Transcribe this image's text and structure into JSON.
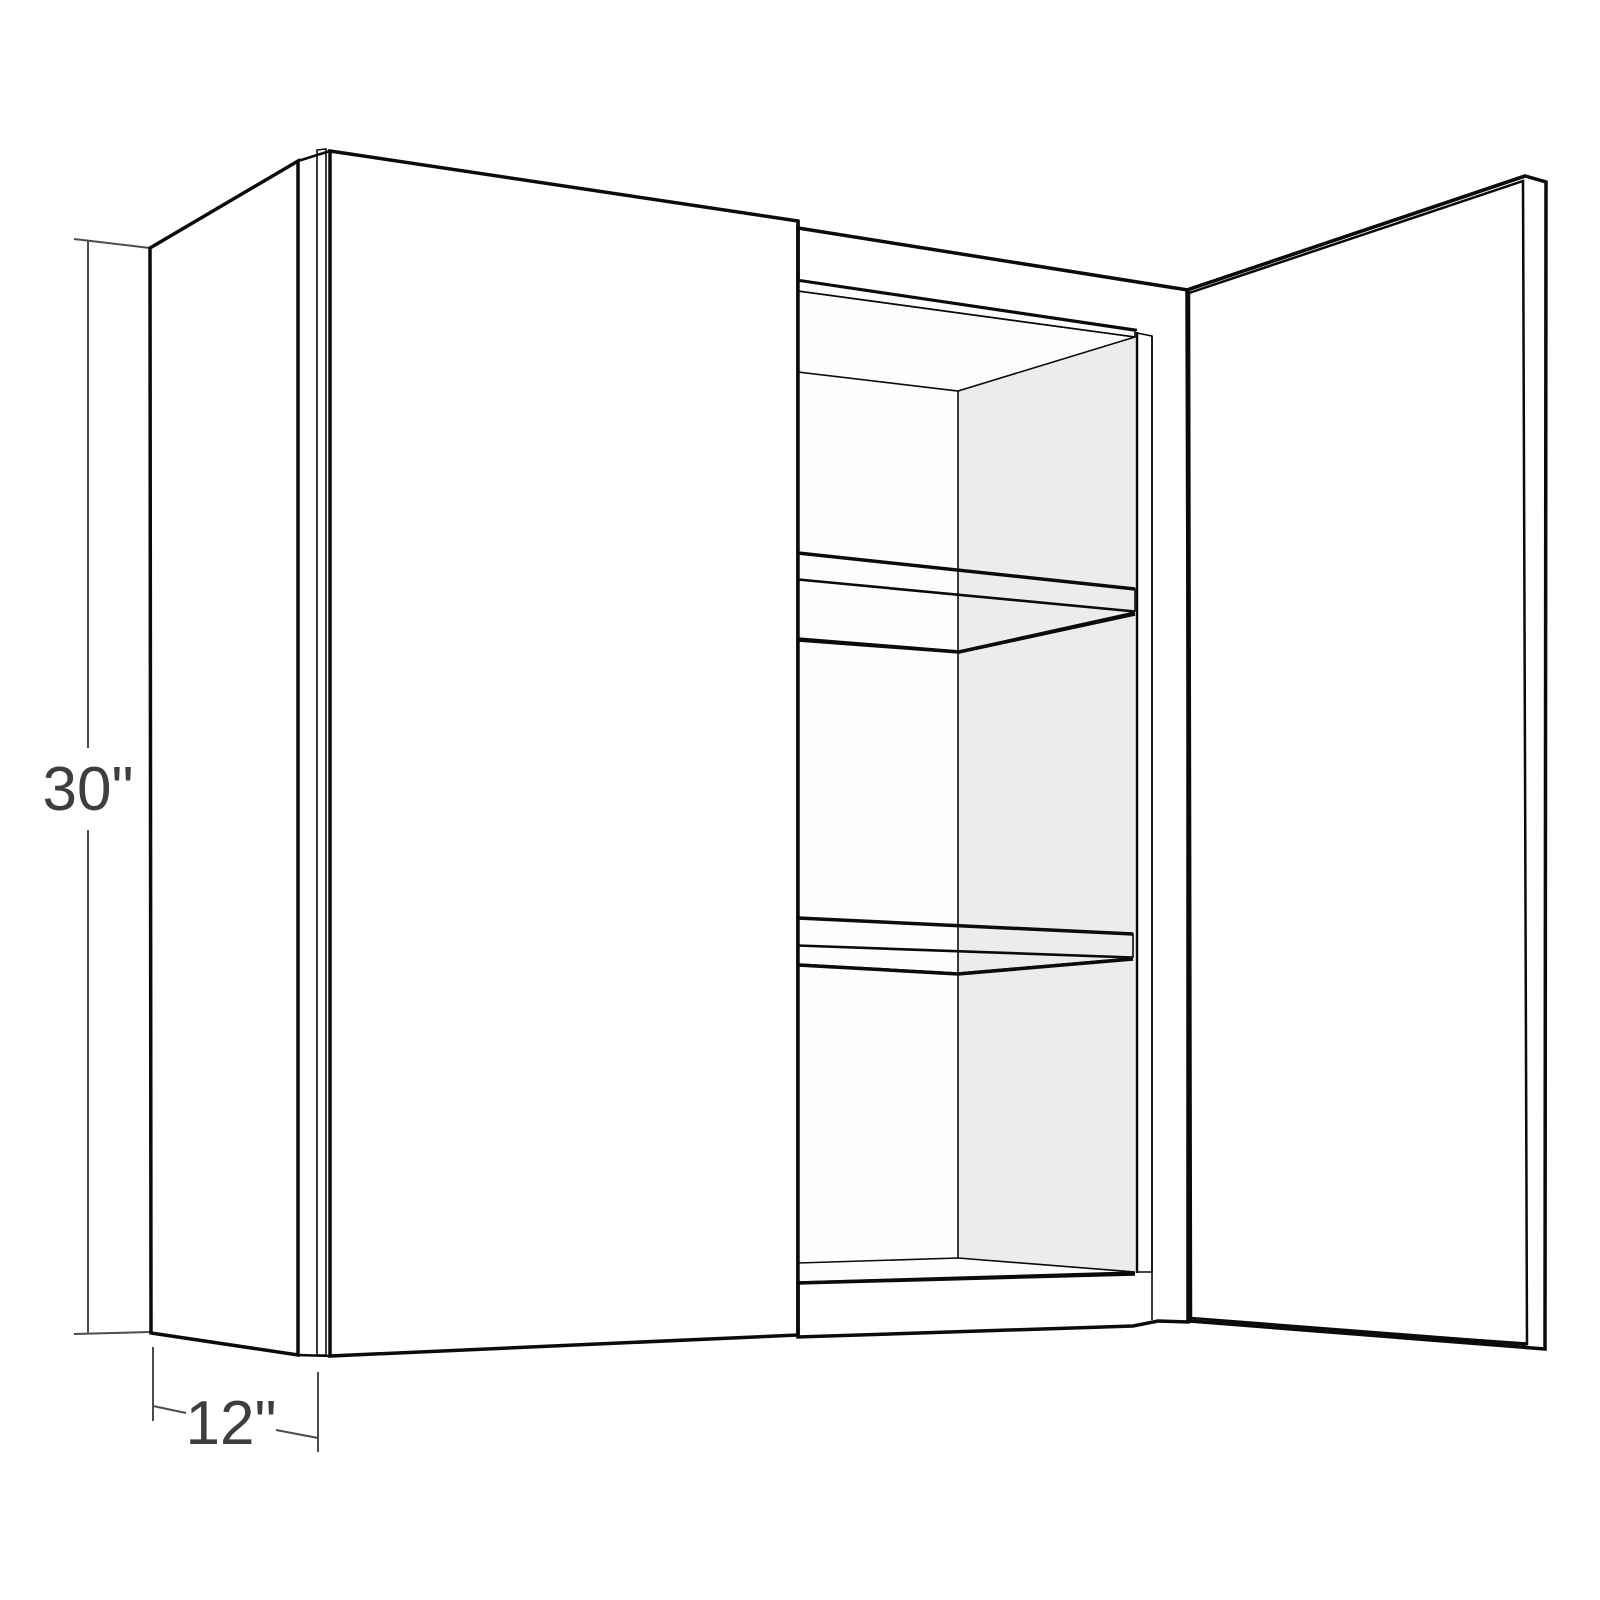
{
  "diagram": {
    "title": "Wall cabinet dimension diagram",
    "subject": "Two-door wall cabinet shown with right door open, interior with two shelves",
    "dimensions": {
      "height_label": "30\"",
      "depth_label": "12\""
    },
    "components": [
      "left side panel",
      "closed left door",
      "face frame",
      "interior back wall",
      "interior right wall",
      "top hanging rail",
      "upper shelf",
      "lower shelf",
      "cabinet bottom",
      "open right door"
    ],
    "colors": {
      "background": "#ffffff",
      "outline": "#0b0b0b",
      "door_face": "#ffffff",
      "side_panel": "#f1f1f1",
      "edge_strip": "#e8e8e8",
      "open_door_face": "#efefef",
      "interior_wall": "#ececec",
      "interior_back": "#fdfdfd",
      "shelf_surface": "#dedede",
      "ceiling_surface": "#e3e3e3",
      "hanging_rail": "#6e787e",
      "stile_inner_edge": "#e9e9e9",
      "dimension_line": "#4c4c4c",
      "dimension_text": "#3e3e3e"
    }
  }
}
